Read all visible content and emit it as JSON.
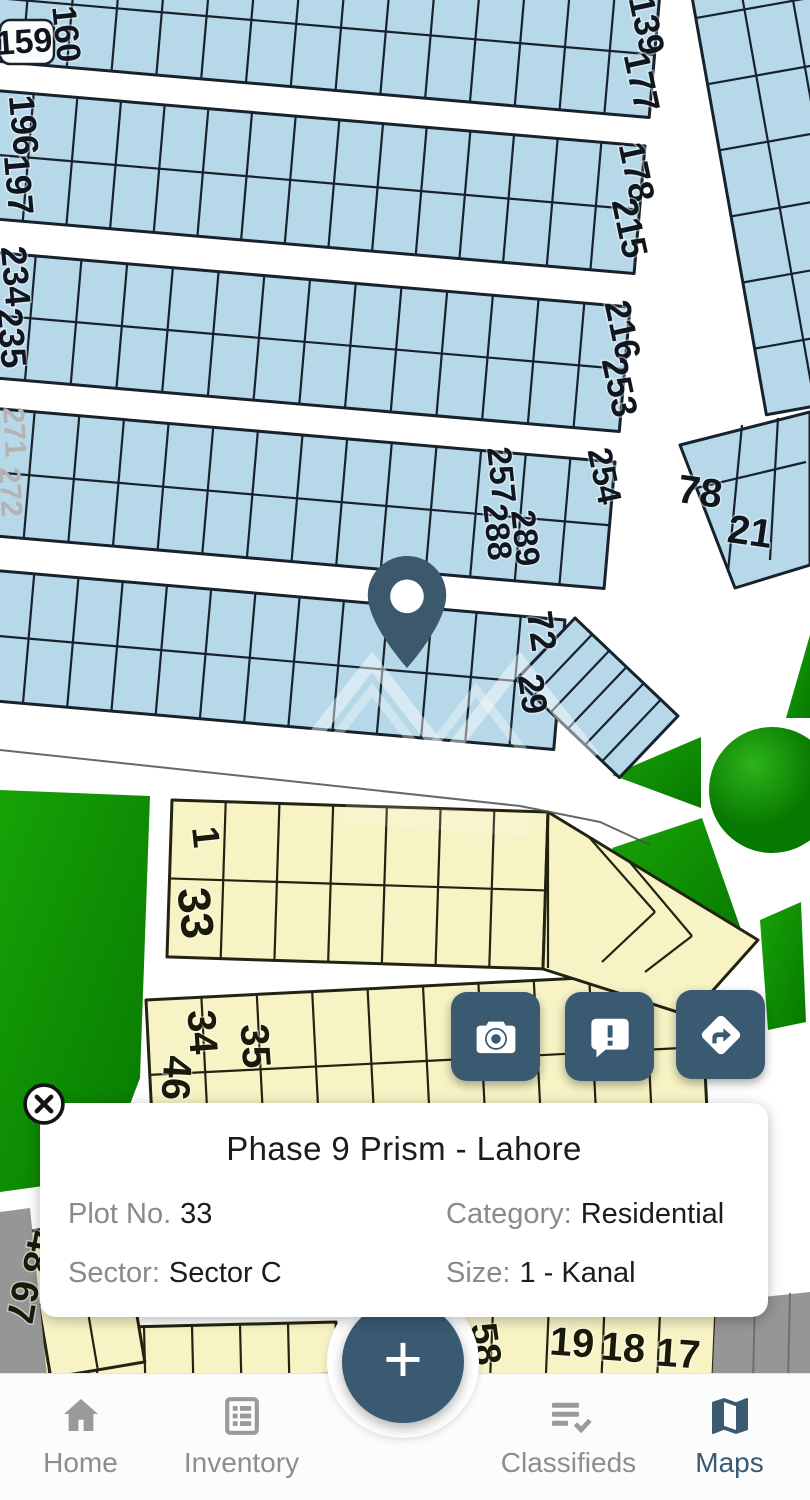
{
  "map": {
    "colors": {
      "accent": "#3A5A72",
      "pin": "#3B586D",
      "plot_blue": "#B6D8E8",
      "plot_outline_blue": "#17222C",
      "plot_yellow": "#F7F3C5",
      "plot_outline_yellow": "#232312",
      "green": "#0F9C03",
      "green_dark": "#077800",
      "green_light": "#2DB41A",
      "road_white": "#FFFFFF",
      "boundary_gray": "#969696",
      "nav_inactive": "#9A9A9A",
      "text_dark": "#1C1C1C",
      "text_gray": "#8A8A8A"
    },
    "plot_labels": [
      {
        "t": "159",
        "x": 24,
        "y": 42,
        "r": -4,
        "s": 34
      },
      {
        "t": "160",
        "x": 66,
        "y": 34,
        "r": 84,
        "s": 34
      },
      {
        "t": "139",
        "x": 647,
        "y": 25,
        "r": 78,
        "s": 36
      },
      {
        "t": "177",
        "x": 642,
        "y": 82,
        "r": 78,
        "s": 36
      },
      {
        "t": "196",
        "x": 24,
        "y": 125,
        "r": 85,
        "s": 36
      },
      {
        "t": "197",
        "x": 19,
        "y": 185,
        "r": 85,
        "s": 36
      },
      {
        "t": "178",
        "x": 637,
        "y": 172,
        "r": 78,
        "s": 36
      },
      {
        "t": "215",
        "x": 630,
        "y": 228,
        "r": 78,
        "s": 36
      },
      {
        "t": "234",
        "x": 16,
        "y": 276,
        "r": 85,
        "s": 36
      },
      {
        "t": "235",
        "x": 12,
        "y": 338,
        "r": 85,
        "s": 36
      },
      {
        "t": "216",
        "x": 623,
        "y": 330,
        "r": 78,
        "s": 36
      },
      {
        "t": "253",
        "x": 620,
        "y": 387,
        "r": 78,
        "s": 36
      },
      {
        "t": "271",
        "x": 14,
        "y": 432,
        "r": 87,
        "s": 30,
        "cls": "f"
      },
      {
        "t": "272",
        "x": 10,
        "y": 492,
        "r": 87,
        "s": 30,
        "cls": "f"
      },
      {
        "t": "257",
        "x": 501,
        "y": 475,
        "r": 84,
        "s": 34
      },
      {
        "t": "254",
        "x": 604,
        "y": 476,
        "r": 78,
        "s": 34
      },
      {
        "t": "288",
        "x": 497,
        "y": 532,
        "r": 84,
        "s": 34
      },
      {
        "t": "289",
        "x": 525,
        "y": 538,
        "r": 84,
        "s": 34
      },
      {
        "t": "78",
        "x": 700,
        "y": 492,
        "r": 8,
        "s": 40
      },
      {
        "t": "21",
        "x": 750,
        "y": 532,
        "r": 8,
        "s": 40
      },
      {
        "t": "72",
        "x": 542,
        "y": 631,
        "r": 82,
        "s": 36
      },
      {
        "t": "29",
        "x": 533,
        "y": 694,
        "r": 82,
        "s": 36
      },
      {
        "t": "1",
        "x": 205,
        "y": 837,
        "r": 84,
        "s": 38,
        "cls": "y"
      },
      {
        "t": "33",
        "x": 196,
        "y": 913,
        "r": 84,
        "s": 46,
        "cls": "y"
      },
      {
        "t": "34",
        "x": 202,
        "y": 1032,
        "r": 86,
        "s": 40,
        "cls": "y"
      },
      {
        "t": "46",
        "x": 176,
        "y": 1078,
        "r": 94,
        "s": 40,
        "cls": "y"
      },
      {
        "t": "35",
        "x": 255,
        "y": 1046,
        "r": 86,
        "s": 40,
        "cls": "y"
      },
      {
        "t": "48",
        "x": 38,
        "y": 1252,
        "r": 100,
        "s": 38,
        "cls": "y"
      },
      {
        "t": "67",
        "x": 22,
        "y": 1302,
        "r": 100,
        "s": 38,
        "cls": "y"
      },
      {
        "t": "58",
        "x": 485,
        "y": 1344,
        "r": 82,
        "s": 38,
        "cls": "y"
      },
      {
        "t": "19",
        "x": 572,
        "y": 1343,
        "r": 4,
        "s": 40,
        "cls": "y"
      },
      {
        "t": "18",
        "x": 623,
        "y": 1348,
        "r": 4,
        "s": 40,
        "cls": "y"
      },
      {
        "t": "17",
        "x": 678,
        "y": 1354,
        "r": 4,
        "s": 40,
        "cls": "y"
      }
    ],
    "info_card": {
      "title": "Phase 9 Prism - Lahore",
      "fields": [
        {
          "label": "Plot No.",
          "value": "33"
        },
        {
          "label": "Category:",
          "value": "Residential"
        },
        {
          "label": "Sector:",
          "value": "Sector C"
        },
        {
          "label": "Size:",
          "value": "1 - Kanal"
        }
      ]
    }
  },
  "action_buttons": [
    {
      "icon": "camera-icon"
    },
    {
      "icon": "feedback-icon"
    },
    {
      "icon": "directions-icon"
    }
  ],
  "fab": {
    "label": "+"
  },
  "nav": {
    "items": [
      {
        "label": "Home",
        "icon": "home-icon",
        "active": false
      },
      {
        "label": "Inventory",
        "icon": "inventory-icon",
        "active": false
      },
      {
        "label": "Classifieds",
        "icon": "classifieds-icon",
        "active": false
      },
      {
        "label": "Maps",
        "icon": "maps-icon",
        "active": true
      }
    ]
  }
}
